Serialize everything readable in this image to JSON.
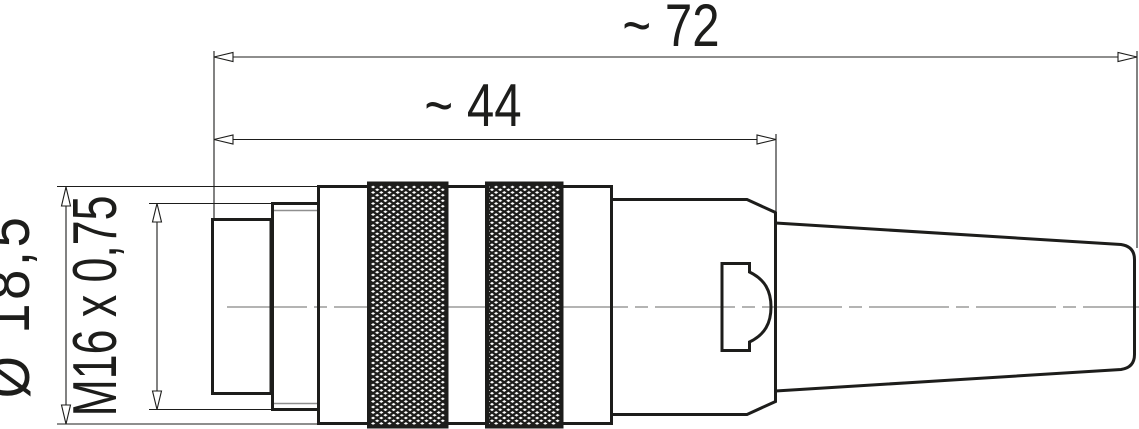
{
  "drawing": {
    "type": "technical-dimension-drawing",
    "subject": "M16 cable connector, male, side view"
  },
  "dims": {
    "overall_length": "~ 72",
    "front_length": "~ 44",
    "diameter": "Ø 18,5",
    "thread": "M16 x 0,75"
  },
  "colors": {
    "line": "#1d1d1b",
    "centerline": "#9b9b9a",
    "background": "#ffffff"
  }
}
